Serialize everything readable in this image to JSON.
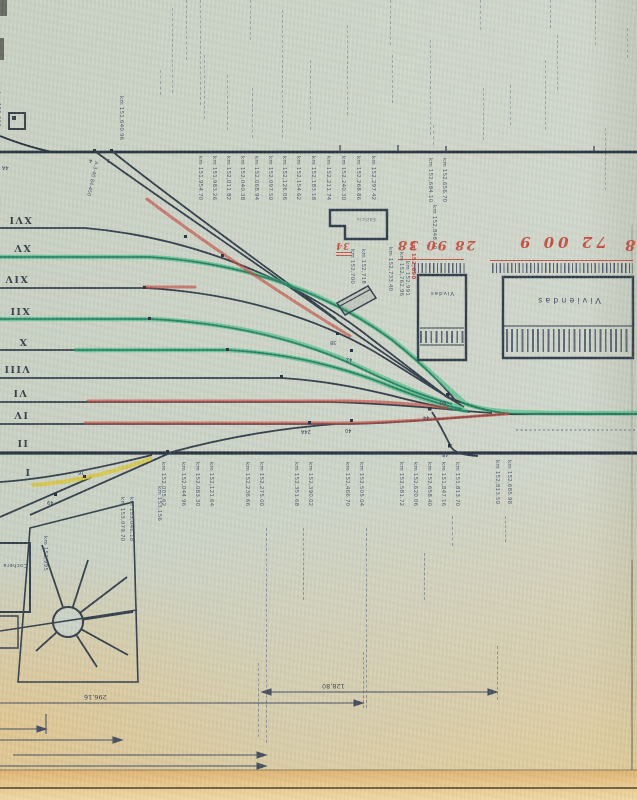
{
  "track_numbers": [
    {
      "t": "XVI",
      "x": 8,
      "y": 214
    },
    {
      "t": "XV",
      "x": 13,
      "y": 242
    },
    {
      "t": "XIV",
      "x": 4,
      "y": 273
    },
    {
      "t": "XII",
      "x": 9,
      "y": 305
    },
    {
      "t": "X",
      "x": 18,
      "y": 336
    },
    {
      "t": "VIII",
      "x": 3,
      "y": 363
    },
    {
      "t": "VI",
      "x": 12,
      "y": 387
    },
    {
      "t": "IV",
      "x": 13,
      "y": 409
    },
    {
      "t": "II",
      "x": 16,
      "y": 437
    },
    {
      "t": "I",
      "x": 24,
      "y": 466
    }
  ],
  "top_kms": [
    {
      "t": "km 151,640.96",
      "x": 124,
      "y": 96
    },
    {
      "t": "km 151,612",
      "x": 1,
      "y": 92
    }
  ],
  "throat_kms": [
    {
      "t": "km 151,954.70",
      "x": 203,
      "y": 156
    },
    {
      "t": "km 151,983.26",
      "x": 217,
      "y": 156
    },
    {
      "t": "km 152,011.82",
      "x": 231,
      "y": 156
    },
    {
      "t": "km 152,040.38",
      "x": 245,
      "y": 156
    },
    {
      "t": "km 152,068.94",
      "x": 259,
      "y": 156
    },
    {
      "t": "km 152,097.50",
      "x": 273,
      "y": 156
    },
    {
      "t": "km 152,126.06",
      "x": 287,
      "y": 156
    },
    {
      "t": "km 152,154.62",
      "x": 301,
      "y": 156
    },
    {
      "t": "km 152,183.18",
      "x": 316,
      "y": 156
    },
    {
      "t": "km 152,211.74",
      "x": 331,
      "y": 156
    },
    {
      "t": "km 152,240.30",
      "x": 346,
      "y": 156
    },
    {
      "t": "km 152,268.86",
      "x": 361,
      "y": 156
    },
    {
      "t": "km 152,297.42",
      "x": 376,
      "y": 156
    },
    {
      "t": "km 152,684.10",
      "x": 433,
      "y": 158
    },
    {
      "t": "km 152,656.70",
      "x": 447,
      "y": 158
    },
    {
      "t": "km 152,848.10",
      "x": 437,
      "y": 205
    }
  ],
  "mid_kms": [
    {
      "t": "km 152,733.40",
      "x": 393,
      "y": 247
    },
    {
      "t": "km 152,762.96",
      "x": 404,
      "y": 252
    },
    {
      "t": "km 152,991",
      "x": 410,
      "y": 261
    },
    {
      "t": "km 152,700",
      "x": 355,
      "y": 249
    },
    {
      "t": "km 152,718",
      "x": 366,
      "y": 249
    }
  ],
  "bottom_kms": [
    {
      "t": "km 152,005.62",
      "x": 166,
      "y": 462
    },
    {
      "t": "km 152,044.96",
      "x": 186,
      "y": 462
    },
    {
      "t": "km 152,083.30",
      "x": 200,
      "y": 462
    },
    {
      "t": "km 152,121.64",
      "x": 214,
      "y": 462
    },
    {
      "t": "km 152,236.66",
      "x": 250,
      "y": 462
    },
    {
      "t": "km 152,275.00",
      "x": 264,
      "y": 462
    },
    {
      "t": "km 152,351.68",
      "x": 299,
      "y": 462
    },
    {
      "t": "km 152,390.02",
      "x": 313,
      "y": 462
    },
    {
      "t": "km 152,466.70",
      "x": 350,
      "y": 462
    },
    {
      "t": "km 152,505.04",
      "x": 364,
      "y": 462
    },
    {
      "t": "km 152,581.72",
      "x": 404,
      "y": 462
    },
    {
      "t": "km 152,620.06",
      "x": 418,
      "y": 462
    },
    {
      "t": "km 152,658.40",
      "x": 432,
      "y": 462
    },
    {
      "t": "km 151,847.16",
      "x": 446,
      "y": 462
    },
    {
      "t": "km 151,813.70",
      "x": 460,
      "y": 462
    },
    {
      "t": "km 152,813.50",
      "x": 500,
      "y": 460
    },
    {
      "t": "km 152,685.98",
      "x": 512,
      "y": 460
    }
  ],
  "depot_kms": [
    {
      "t": "km 153,079.70",
      "x": 125,
      "y": 497
    },
    {
      "t": "km 153,046.18",
      "x": 134,
      "y": 497
    },
    {
      "t": "km 152,995",
      "x": 48,
      "y": 536
    },
    {
      "t": "km 153,156",
      "x": 162,
      "y": 486
    }
  ],
  "switches": [
    {
      "t": "4",
      "x": 89,
      "y": 157
    },
    {
      "t": "9",
      "x": 107,
      "y": 157
    },
    {
      "t": "4A",
      "x": 2,
      "y": 164
    },
    {
      "t": "38",
      "x": 330,
      "y": 339
    },
    {
      "t": "42",
      "x": 346,
      "y": 356
    },
    {
      "t": "24A",
      "x": 301,
      "y": 428
    },
    {
      "t": "40",
      "x": 345,
      "y": 427
    },
    {
      "t": "44",
      "x": 423,
      "y": 414
    },
    {
      "t": "50",
      "x": 440,
      "y": 399
    },
    {
      "t": "48",
      "x": 442,
      "y": 451
    },
    {
      "t": "16",
      "x": 78,
      "y": 469
    },
    {
      "t": "49",
      "x": 47,
      "y": 499
    }
  ],
  "red": {
    "left_numbers": "28 90 38",
    "right_numbers": "72 00 9",
    "edge_number": "28",
    "building_number": "34",
    "km_note": "km 152,690"
  },
  "buildings": {
    "station": "Edificio",
    "viviendas": "Viviendas",
    "small": "Vivdas",
    "cochera": "Cochera"
  },
  "dims": [
    {
      "t": "128,80",
      "x": 322,
      "y": 682
    },
    {
      "t": "296,16",
      "x": 84,
      "y": 693
    }
  ],
  "note_left": "A.3-40  84-450",
  "pencil_dashes": [
    {
      "x": 160,
      "y": 70,
      "h": 25
    },
    {
      "x": 172,
      "y": 8,
      "h": 85
    },
    {
      "x": 186,
      "y": 0,
      "h": 60
    },
    {
      "x": 200,
      "y": 0,
      "h": 105
    },
    {
      "x": 204,
      "y": 55,
      "h": 64
    },
    {
      "x": 227,
      "y": 75,
      "h": 55
    },
    {
      "x": 250,
      "y": 0,
      "h": 40
    },
    {
      "x": 252,
      "y": 88,
      "h": 50
    },
    {
      "x": 282,
      "y": 10,
      "h": 128
    },
    {
      "x": 310,
      "y": 60,
      "h": 70
    },
    {
      "x": 347,
      "y": 25,
      "h": 90
    },
    {
      "x": 390,
      "y": 0,
      "h": 45
    },
    {
      "x": 392,
      "y": 55,
      "h": 48
    },
    {
      "x": 430,
      "y": 40,
      "h": 95
    },
    {
      "x": 433,
      "y": 125,
      "h": 20
    },
    {
      "x": 480,
      "y": 0,
      "h": 30
    },
    {
      "x": 483,
      "y": 88,
      "h": 52
    },
    {
      "x": 510,
      "y": 85,
      "h": 40
    },
    {
      "x": 545,
      "y": 60,
      "h": 70
    },
    {
      "x": 550,
      "y": 0,
      "h": 28
    },
    {
      "x": 557,
      "y": 35,
      "h": 55
    },
    {
      "x": 595,
      "y": 0,
      "h": 45
    },
    {
      "x": 605,
      "y": 128,
      "h": 62
    },
    {
      "x": 627,
      "y": 28,
      "h": 30
    }
  ],
  "ink_leaders": [
    {
      "x": 266,
      "y": 528,
      "h": 215
    },
    {
      "x": 303,
      "y": 528,
      "h": 72
    },
    {
      "x": 366,
      "y": 528,
      "h": 180
    },
    {
      "x": 424,
      "y": 553,
      "h": 47
    },
    {
      "x": 497,
      "y": 646,
      "h": 54
    },
    {
      "x": 452,
      "y": 516,
      "h": 30
    },
    {
      "x": 505,
      "y": 516,
      "h": 26
    },
    {
      "x": 258,
      "y": 663,
      "h": 74
    },
    {
      "x": 363,
      "y": 652,
      "h": 56
    }
  ],
  "combs": [
    {
      "x": 492,
      "y": 263,
      "w": 141,
      "h": 10
    },
    {
      "x": 414,
      "y": 263,
      "w": 52,
      "h": 10
    }
  ],
  "hatchbands": [
    {
      "x": 506,
      "y": 329,
      "w": 123,
      "h": 23
    },
    {
      "x": 420,
      "y": 331,
      "w": 44,
      "h": 12
    }
  ],
  "colors": {
    "paper": "#ccd3c6",
    "ink": "#2e3a48",
    "green_marker": "#1fb873",
    "red_marker": "#c5463a",
    "yellow_marker": "#d9c62e",
    "red_pen": "#c23a2b",
    "bottom_edge": "#e8c486"
  }
}
